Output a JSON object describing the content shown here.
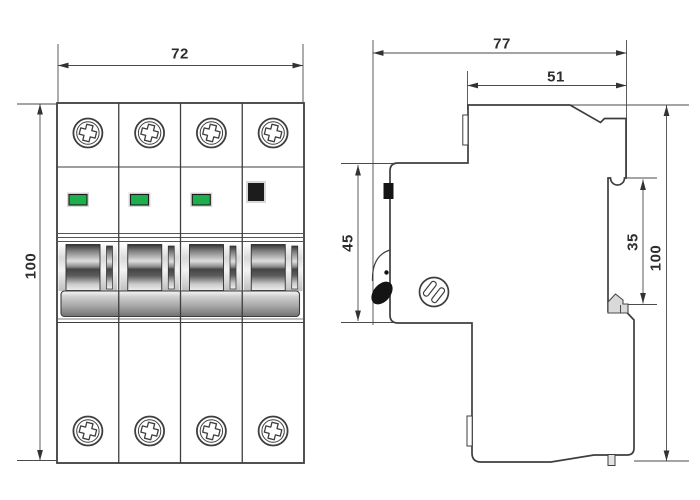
{
  "dims": {
    "front_width": "72",
    "front_height": "100",
    "side_total_depth": "77",
    "side_upper_depth": "51",
    "side_front_height": "45",
    "side_recess_height": "35",
    "side_total_height": "100"
  },
  "front_view": {
    "poles": 4,
    "indicator_windows": [
      "green",
      "green",
      "green",
      "black"
    ]
  },
  "colors": {
    "line": "#3e3e3e",
    "dimension_line": "#4a4a4a",
    "indicator_green": "#1fae4d",
    "indicator_black": "#1e1b1b",
    "handle_black": "#141414",
    "gray_light": "#e9e9e9",
    "gray_dark": "#6f6f6f"
  }
}
